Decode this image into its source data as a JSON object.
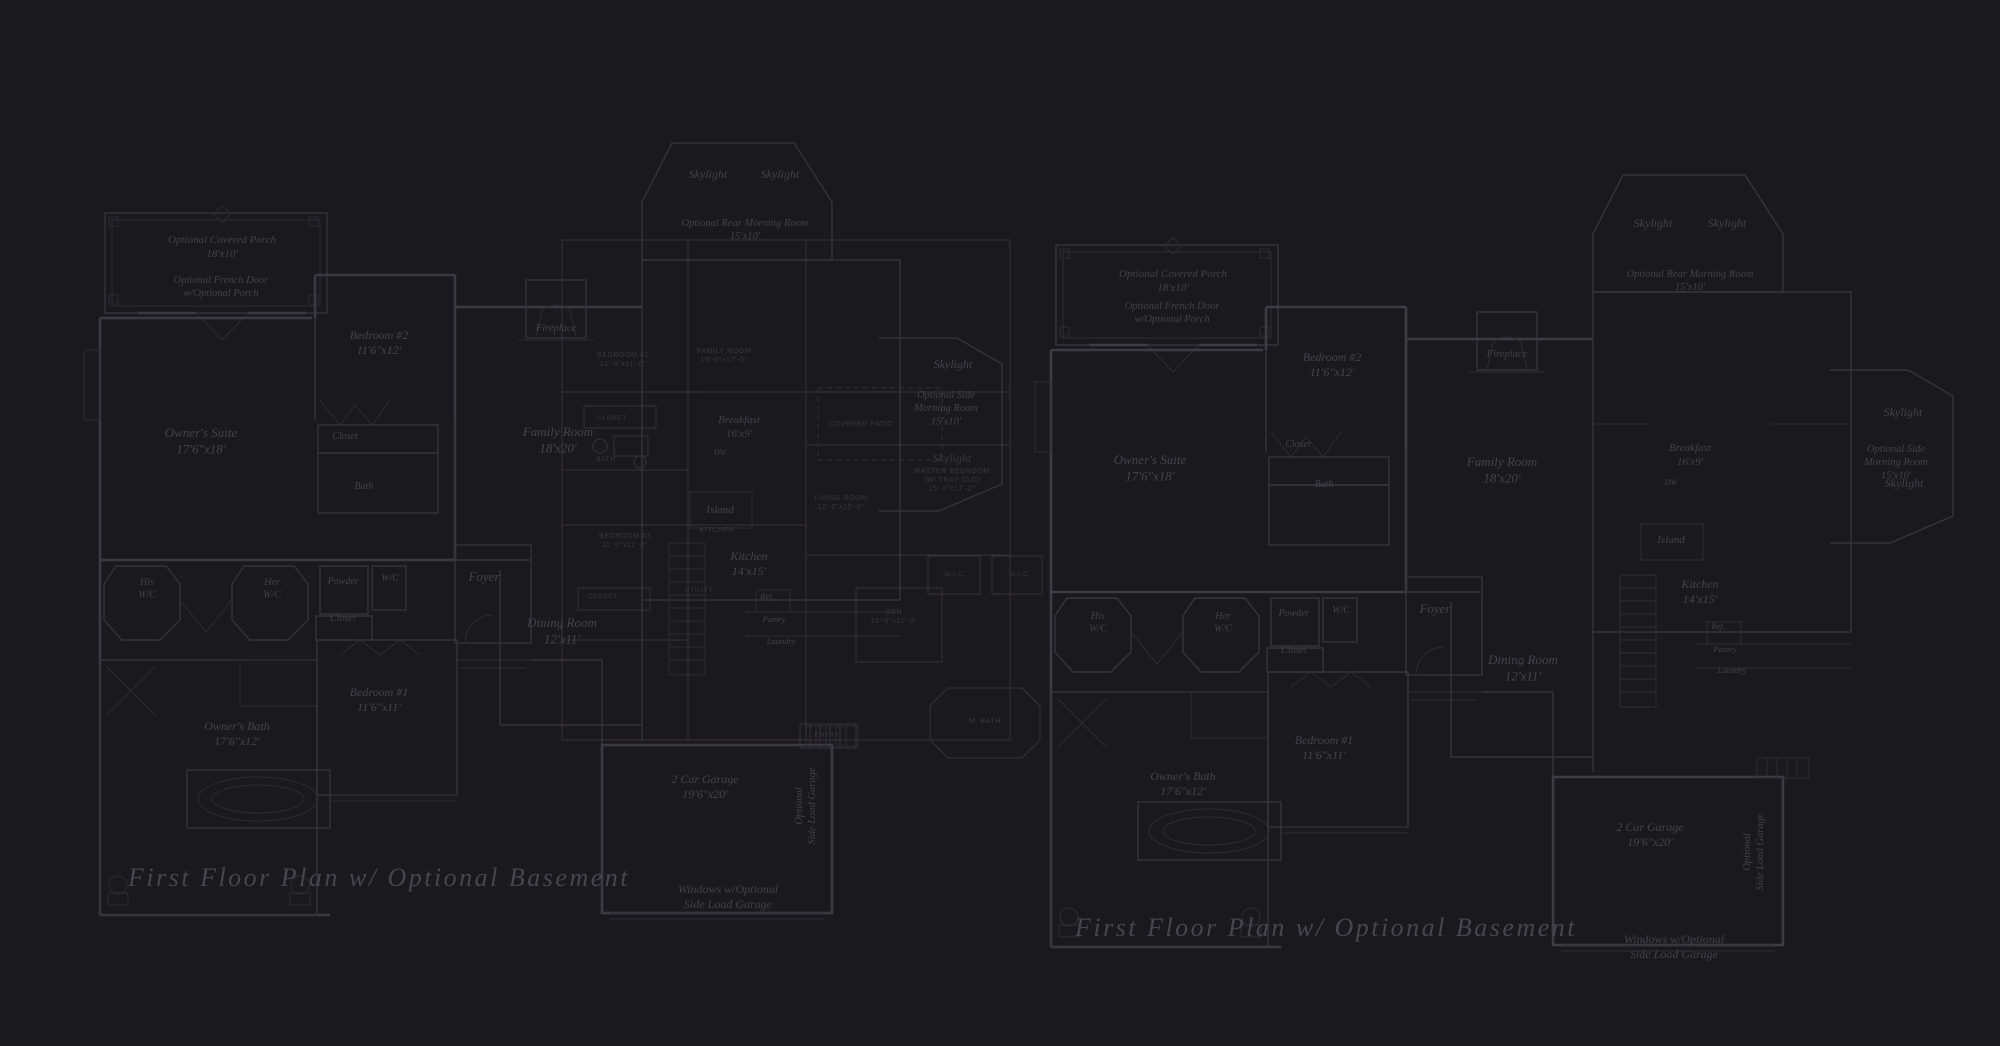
{
  "page": {
    "title": "First Floor Plan w/ Optional Basement",
    "colors": {
      "background": "#1a191d",
      "wall_line": "#36353c",
      "heavy_wall_line": "#3d3c44",
      "room_label_text": "#45434c",
      "small_plan_text": "#39383f",
      "caption_text": "#47454e",
      "tile_grid": "#26252b"
    }
  },
  "plans": [
    {
      "id": "left-first-floor-plan",
      "caption": "First Floor Plan  w/ Optional Basement",
      "labels": [
        {
          "name": "covered-porch-label",
          "lines": [
            "Optional Covered Porch",
            "18'x10'"
          ],
          "x": 222,
          "y": 243,
          "size": 11
        },
        {
          "name": "french-door-label",
          "lines": [
            "Optional French Door",
            "w/Optional Porch"
          ],
          "x": 221,
          "y": 283,
          "size": 10.5
        },
        {
          "name": "bedroom2-label",
          "lines": [
            "Bedroom #2",
            "11'6\"x12'"
          ],
          "x": 379,
          "y": 339,
          "size": 12,
          "style": "room"
        },
        {
          "name": "closet-label-bedroom2",
          "lines": [
            "Closet"
          ],
          "x": 345,
          "y": 439,
          "size": 10
        },
        {
          "name": "bath-label",
          "lines": [
            "Bath"
          ],
          "x": 364,
          "y": 489,
          "size": 10
        },
        {
          "name": "owners-suite-label",
          "lines": [
            "Owner's Suite",
            "17'6\"x18'"
          ],
          "x": 201,
          "y": 437,
          "size": 13,
          "style": "room"
        },
        {
          "name": "skylight-rear-left-label",
          "lines": [
            "Skylight"
          ],
          "x": 708,
          "y": 178,
          "size": 12
        },
        {
          "name": "skylight-rear-right-label",
          "lines": [
            "Skylight"
          ],
          "x": 780,
          "y": 178,
          "size": 12
        },
        {
          "name": "rear-morning-room-label",
          "lines": [
            "Optional Rear Morning Room",
            "15'x10'"
          ],
          "x": 745,
          "y": 226,
          "size": 10.5
        },
        {
          "name": "fireplace-label",
          "lines": [
            "Fireplace"
          ],
          "x": 556,
          "y": 331,
          "size": 10.5
        },
        {
          "name": "family-room-label",
          "lines": [
            "Family Room",
            "18'x20'"
          ],
          "x": 558,
          "y": 436,
          "size": 13,
          "style": "room"
        },
        {
          "name": "his-wc-label",
          "lines": [
            "His",
            "W/C"
          ],
          "x": 147,
          "y": 585,
          "size": 10
        },
        {
          "name": "her-wc-label",
          "lines": [
            "Her",
            "W/C"
          ],
          "x": 272,
          "y": 585,
          "size": 10
        },
        {
          "name": "powder-label",
          "lines": [
            "Powder"
          ],
          "x": 343,
          "y": 584,
          "size": 10
        },
        {
          "name": "wc-label",
          "lines": [
            "W/C"
          ],
          "x": 390,
          "y": 581,
          "size": 10
        },
        {
          "name": "closet-label-hall",
          "lines": [
            "Closet"
          ],
          "x": 343,
          "y": 621,
          "size": 10
        },
        {
          "name": "foyer-label",
          "lines": [
            "Foyer"
          ],
          "x": 484,
          "y": 581,
          "size": 13,
          "style": "room"
        },
        {
          "name": "dining-room-label",
          "lines": [
            "Dining Room",
            "12'x11'"
          ],
          "x": 562,
          "y": 627,
          "size": 13,
          "style": "room"
        },
        {
          "name": "breakfast-label",
          "lines": [
            "Breakfast",
            "16'x9'"
          ],
          "x": 739,
          "y": 423,
          "size": 11
        },
        {
          "name": "dw-label",
          "lines": [
            "DW"
          ],
          "x": 720,
          "y": 455,
          "size": 8
        },
        {
          "name": "island-label",
          "lines": [
            "Island"
          ],
          "x": 720,
          "y": 513,
          "size": 11
        },
        {
          "name": "kitchen-label",
          "lines": [
            "Kitchen",
            "14'x15'"
          ],
          "x": 749,
          "y": 560,
          "size": 12,
          "style": "room"
        },
        {
          "name": "ref-label",
          "lines": [
            "Ref."
          ],
          "x": 767,
          "y": 599,
          "size": 8.5
        },
        {
          "name": "pantry-label",
          "lines": [
            "Pantry"
          ],
          "x": 774,
          "y": 622,
          "size": 8.5
        },
        {
          "name": "laundry-label",
          "lines": [
            "Laundry"
          ],
          "x": 781,
          "y": 644,
          "size": 8.5
        },
        {
          "name": "skylight-side-top-label",
          "lines": [
            "Skylight"
          ],
          "x": 953,
          "y": 368,
          "size": 12
        },
        {
          "name": "side-morning-room-label",
          "lines": [
            "Optional Side",
            "Morning Room",
            "15'x10'"
          ],
          "x": 946,
          "y": 398,
          "size": 10.5
        },
        {
          "name": "skylight-side-bottom-label",
          "lines": [
            "Skylight"
          ],
          "x": 952,
          "y": 462,
          "size": 12,
          "style": "faint"
        },
        {
          "name": "bedroom1-label",
          "lines": [
            "Bedroom #1",
            "11'6\"x11'"
          ],
          "x": 379,
          "y": 696,
          "size": 12,
          "style": "room"
        },
        {
          "name": "owners-bath-label",
          "lines": [
            "Owner's Bath",
            "17'6\"x12'"
          ],
          "x": 237,
          "y": 730,
          "size": 12,
          "style": "room"
        },
        {
          "name": "garage-label",
          "lines": [
            "2 Car Garage",
            "19'6\"x20'"
          ],
          "x": 705,
          "y": 783,
          "size": 12,
          "style": "room"
        },
        {
          "name": "side-load-garage-label",
          "lines": [
            "Optional",
            "Side Load Garage"
          ],
          "x": 802,
          "y": 806,
          "size": 10.5,
          "rotate": -90
        },
        {
          "name": "windows-optional-label",
          "lines": [
            "Windows w/Optional",
            "Side Load Garage"
          ],
          "x": 728,
          "y": 893,
          "size": 12
        },
        {
          "name": "plan-caption",
          "lines": [
            "First Floor Plan  w/ Optional Basement"
          ],
          "x": 128,
          "y": 886,
          "size": 26,
          "style": "caption",
          "anchor": "start"
        }
      ]
    },
    {
      "id": "right-first-floor-plan",
      "caption": "First Floor Plan  w/ Optional Basement",
      "labels": [
        {
          "name": "covered-porch-label",
          "lines": [
            "Optional Covered Porch",
            "18'x10'"
          ],
          "x": 1173,
          "y": 277,
          "size": 11
        },
        {
          "name": "french-door-label",
          "lines": [
            "Optional French Door",
            "w/Optional Porch"
          ],
          "x": 1172,
          "y": 309,
          "size": 10.5
        },
        {
          "name": "bedroom2-label",
          "lines": [
            "Bedroom #2",
            "11'6\"x12'"
          ],
          "x": 1332,
          "y": 361,
          "size": 12,
          "style": "room"
        },
        {
          "name": "closet-label-bedroom2",
          "lines": [
            "Closet"
          ],
          "x": 1298,
          "y": 447,
          "size": 10
        },
        {
          "name": "bath-label",
          "lines": [
            "Bath"
          ],
          "x": 1324,
          "y": 487,
          "size": 10
        },
        {
          "name": "owners-suite-label",
          "lines": [
            "Owner's Suite",
            "17'6\"x18'"
          ],
          "x": 1150,
          "y": 464,
          "size": 13,
          "style": "room"
        },
        {
          "name": "skylight-rear-left-label",
          "lines": [
            "Skylight"
          ],
          "x": 1653,
          "y": 227,
          "size": 12
        },
        {
          "name": "skylight-rear-right-label",
          "lines": [
            "Skylight"
          ],
          "x": 1727,
          "y": 227,
          "size": 12
        },
        {
          "name": "rear-morning-room-label",
          "lines": [
            "Optional Rear Morning Room",
            "15'x10'"
          ],
          "x": 1690,
          "y": 277,
          "size": 10.5
        },
        {
          "name": "fireplace-label",
          "lines": [
            "Fireplace"
          ],
          "x": 1507,
          "y": 357,
          "size": 10.5
        },
        {
          "name": "family-room-label",
          "lines": [
            "Family Room",
            "18'x20'"
          ],
          "x": 1502,
          "y": 466,
          "size": 13,
          "style": "room"
        },
        {
          "name": "his-wc-label",
          "lines": [
            "His",
            "W/C"
          ],
          "x": 1098,
          "y": 619,
          "size": 10
        },
        {
          "name": "her-wc-label",
          "lines": [
            "Her",
            "W/C"
          ],
          "x": 1223,
          "y": 619,
          "size": 10
        },
        {
          "name": "powder-label",
          "lines": [
            "Powder"
          ],
          "x": 1294,
          "y": 616,
          "size": 10
        },
        {
          "name": "wc-label",
          "lines": [
            "W/C"
          ],
          "x": 1341,
          "y": 613,
          "size": 10
        },
        {
          "name": "closet-label-hall",
          "lines": [
            "Closet"
          ],
          "x": 1294,
          "y": 653,
          "size": 10
        },
        {
          "name": "foyer-label",
          "lines": [
            "Foyer"
          ],
          "x": 1435,
          "y": 613,
          "size": 13,
          "style": "room"
        },
        {
          "name": "dining-room-label",
          "lines": [
            "Dining Room",
            "12'x11'"
          ],
          "x": 1523,
          "y": 664,
          "size": 13,
          "style": "room"
        },
        {
          "name": "breakfast-label",
          "lines": [
            "Breakfast",
            "16'x9'"
          ],
          "x": 1690,
          "y": 451,
          "size": 11
        },
        {
          "name": "dw-label",
          "lines": [
            "DW"
          ],
          "x": 1671,
          "y": 485,
          "size": 8
        },
        {
          "name": "island-label",
          "lines": [
            "Island"
          ],
          "x": 1671,
          "y": 543,
          "size": 11
        },
        {
          "name": "kitchen-label",
          "lines": [
            "Kitchen",
            "14'x15'"
          ],
          "x": 1700,
          "y": 588,
          "size": 12,
          "style": "room"
        },
        {
          "name": "ref-label",
          "lines": [
            "Ref."
          ],
          "x": 1718,
          "y": 629,
          "size": 8.5
        },
        {
          "name": "pantry-label",
          "lines": [
            "Pantry"
          ],
          "x": 1725,
          "y": 652,
          "size": 8.5
        },
        {
          "name": "laundry-label",
          "lines": [
            "Laundry"
          ],
          "x": 1732,
          "y": 673,
          "size": 8.5
        },
        {
          "name": "skylight-side-top-label",
          "lines": [
            "Skylight"
          ],
          "x": 1903,
          "y": 416,
          "size": 12
        },
        {
          "name": "side-morning-room-label",
          "lines": [
            "Optional Side",
            "Morning Room",
            "15'x10'"
          ],
          "x": 1896,
          "y": 452,
          "size": 10.5
        },
        {
          "name": "skylight-side-bottom-label",
          "lines": [
            "Skylight"
          ],
          "x": 1904,
          "y": 487,
          "size": 12
        },
        {
          "name": "bedroom1-label",
          "lines": [
            "Bedroom #1",
            "11'6\"x11'"
          ],
          "x": 1324,
          "y": 744,
          "size": 12,
          "style": "room"
        },
        {
          "name": "owners-bath-label",
          "lines": [
            "Owner's Bath",
            "17'6\"x12'"
          ],
          "x": 1183,
          "y": 780,
          "size": 12,
          "style": "room"
        },
        {
          "name": "garage-label",
          "lines": [
            "2 Car Garage",
            "19'6\"x20'"
          ],
          "x": 1650,
          "y": 831,
          "size": 12,
          "style": "room"
        },
        {
          "name": "side-load-garage-label",
          "lines": [
            "Optional",
            "Side Load Garage"
          ],
          "x": 1750,
          "y": 852,
          "size": 10.5,
          "rotate": -90
        },
        {
          "name": "windows-optional-label",
          "lines": [
            "Windows w/Optional",
            "Side Load Garage"
          ],
          "x": 1674,
          "y": 943,
          "size": 12
        },
        {
          "name": "plan-caption",
          "lines": [
            "First Floor Plan  w/ Optional Basement"
          ],
          "x": 1075,
          "y": 936,
          "size": 26,
          "style": "caption",
          "anchor": "start"
        }
      ]
    },
    {
      "id": "background-small-plan",
      "caption": null,
      "labels": [
        {
          "name": "small-bedroom2-label",
          "lines": [
            "BEDROOM #2",
            "12'-0\"x11'-0\""
          ],
          "x": 623,
          "y": 357,
          "size": 7,
          "style": "tiny"
        },
        {
          "name": "small-family-room-label",
          "lines": [
            "FAMILY ROOM",
            "15'-0\"x17'-0\""
          ],
          "x": 724,
          "y": 353,
          "size": 7,
          "style": "tiny"
        },
        {
          "name": "small-closet-upper-label",
          "lines": [
            "CLOSET"
          ],
          "x": 612,
          "y": 420,
          "size": 6.5,
          "style": "tiny"
        },
        {
          "name": "small-bath-label",
          "lines": [
            "BATH"
          ],
          "x": 606,
          "y": 461,
          "size": 6.5,
          "style": "tiny"
        },
        {
          "name": "small-covered-patio-label",
          "lines": [
            "COVERED PATIO"
          ],
          "x": 861,
          "y": 426,
          "size": 7,
          "style": "tiny"
        },
        {
          "name": "small-master-bedroom-label",
          "lines": [
            "MASTER BEDROOM",
            "(W/ TRAY CLG)",
            "15'-0\"x17'-2\""
          ],
          "x": 952,
          "y": 473,
          "size": 7,
          "style": "tiny"
        },
        {
          "name": "small-living-room-label",
          "lines": [
            "LIVING ROOM",
            "12'-0\"x15'-0\""
          ],
          "x": 841,
          "y": 500,
          "size": 7,
          "style": "tiny"
        },
        {
          "name": "small-bedroom3-label",
          "lines": [
            "BEDROOM #3",
            "11'-0\"x11'-0\""
          ],
          "x": 625,
          "y": 538,
          "size": 7,
          "style": "tiny"
        },
        {
          "name": "small-kitchen-label",
          "lines": [
            "KITCHEN"
          ],
          "x": 717,
          "y": 532,
          "size": 7,
          "style": "tiny"
        },
        {
          "name": "small-wic-left-label",
          "lines": [
            "W.I.C."
          ],
          "x": 955,
          "y": 576,
          "size": 6.5,
          "style": "tiny"
        },
        {
          "name": "small-wic-right-label",
          "lines": [
            "W.I.C."
          ],
          "x": 1020,
          "y": 576,
          "size": 6.5,
          "style": "tiny"
        },
        {
          "name": "small-utility-label",
          "lines": [
            "UTILITY"
          ],
          "x": 699,
          "y": 592,
          "size": 6.5,
          "style": "tiny"
        },
        {
          "name": "small-closet-lower-label",
          "lines": [
            "CLOSET"
          ],
          "x": 603,
          "y": 598,
          "size": 6.5,
          "style": "tiny"
        },
        {
          "name": "small-den-label",
          "lines": [
            "DEN",
            "10'-0\"x11'-0\""
          ],
          "x": 894,
          "y": 614,
          "size": 7,
          "style": "tiny"
        },
        {
          "name": "small-master-bath-label",
          "lines": [
            "M. BATH"
          ],
          "x": 985,
          "y": 723,
          "size": 7,
          "style": "tiny"
        },
        {
          "name": "small-entry-label",
          "lines": [
            "ENTRY"
          ],
          "x": 827,
          "y": 737,
          "size": 6.5,
          "style": "tiny"
        }
      ]
    }
  ]
}
